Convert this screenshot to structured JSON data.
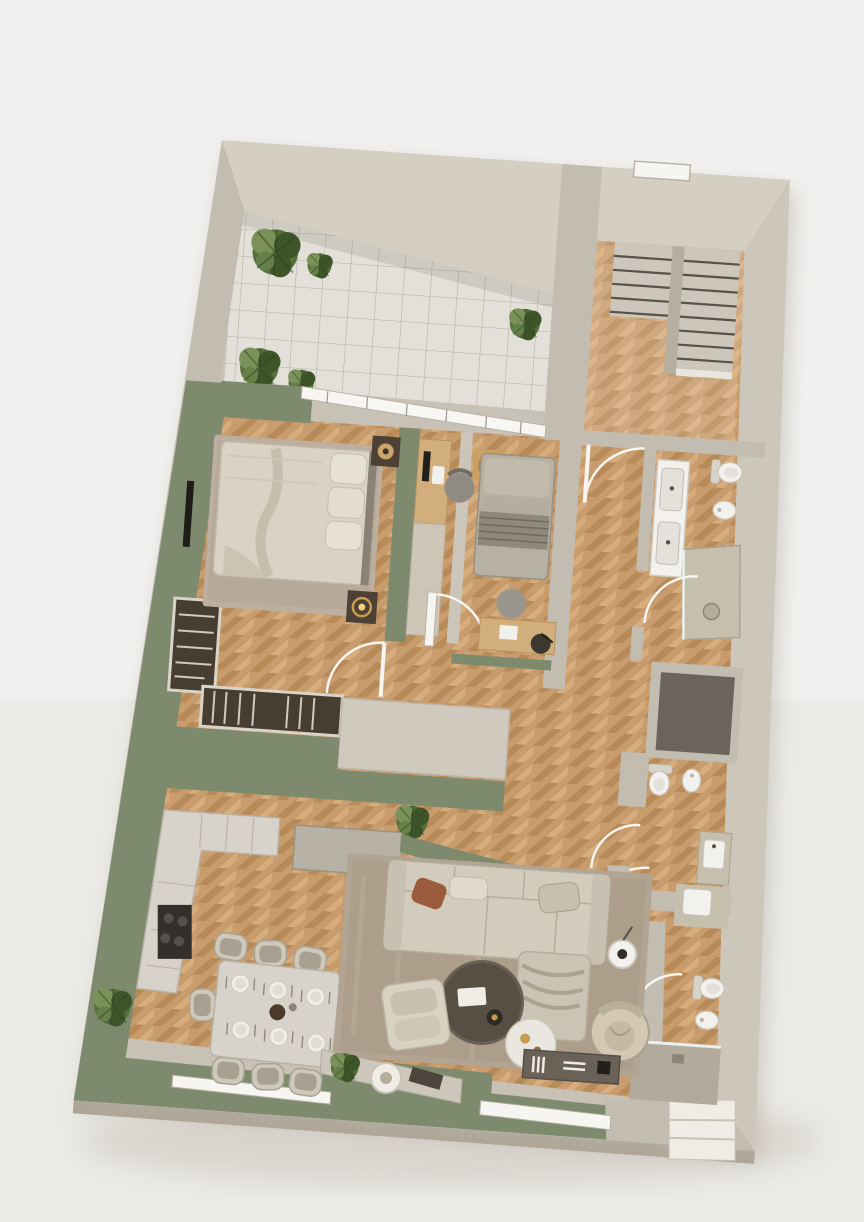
{
  "scene": {
    "title": "3d-apartment-floor-plan-top-view",
    "style": "photorealistic architectural model, rotated ~4 degrees clockwise on off-white backdrop"
  },
  "palette": {
    "background": "#f1f0ee",
    "background_low": "#e8e6e2",
    "model_shadow": "#d9d5ce",
    "wall": "#c8c1b5",
    "wall_light": "#d4cec3",
    "wall_side": "#aca293",
    "green_wall": "#7d8a6e",
    "green_wall_dark": "#6c7a60",
    "wood_base": "#c89c6c",
    "wood_dark": "#b78a57",
    "wood_light": "#d7ad7d",
    "wood_line": "#a87e4e",
    "tile_floor": "#e3e0da",
    "tile_line": "#a9a59c",
    "glazing_white": "#f7f6f3",
    "dark_wood": "#483d31",
    "rug_bedroom": "#bcafa0",
    "rug_living": "#b2a492",
    "sofa": "#d3cbbc",
    "cushion": "#c6bdac",
    "rust_pillow": "#9a5c3c",
    "stone": "#c6bfae",
    "concrete": "#b2aa9c",
    "shaft": "#6b645a",
    "fixture_white": "#f2f1ee",
    "fixture_shadow": "#d6d1c7",
    "charcoal": "#332f29",
    "plant_dark": "#3d5529",
    "plant_mid": "#55713a",
    "plant_light": "#7a9159",
    "lamp_gold": "#c89c50",
    "stair_tread": "#ccc6bb",
    "stair_edge": "#57524a",
    "door_white": "#f6f5f1"
  },
  "rooms": [
    {
      "id": "terrace",
      "label": "tiled terrace with plants"
    },
    {
      "id": "staircase-hall",
      "label": "entry hall with double stair flight"
    },
    {
      "id": "bedroom",
      "label": "bedroom with double bed and wardrobe"
    },
    {
      "id": "study-nook",
      "label": "desk nook with task chair"
    },
    {
      "id": "guest-room",
      "label": "small room with daybed and desk"
    },
    {
      "id": "hallway",
      "label": "herringbone corridor"
    },
    {
      "id": "bathroom-1",
      "label": "bathroom with double vanity and shower"
    },
    {
      "id": "service-shaft",
      "label": "dark service shaft"
    },
    {
      "id": "bathroom-2",
      "label": "wc with toilet, bidet and basin"
    },
    {
      "id": "bathroom-3",
      "label": "shower room off living area"
    },
    {
      "id": "kitchen",
      "label": "kitchen with L-counter and island"
    },
    {
      "id": "dining-area",
      "label": "dining table for eight"
    },
    {
      "id": "living-room",
      "label": "lounge with sectional sofa"
    },
    {
      "id": "entry-steps",
      "label": "white entry steps, bottom right"
    }
  ],
  "furniture_counts": {
    "plants": 8,
    "dining_chairs": 8,
    "dining_plates": 6,
    "toilets_and_bidets": 7,
    "sinks": 4,
    "showers": 3,
    "beds": 2,
    "sofas": 1,
    "armchairs": 2,
    "stair_treads": 14
  }
}
